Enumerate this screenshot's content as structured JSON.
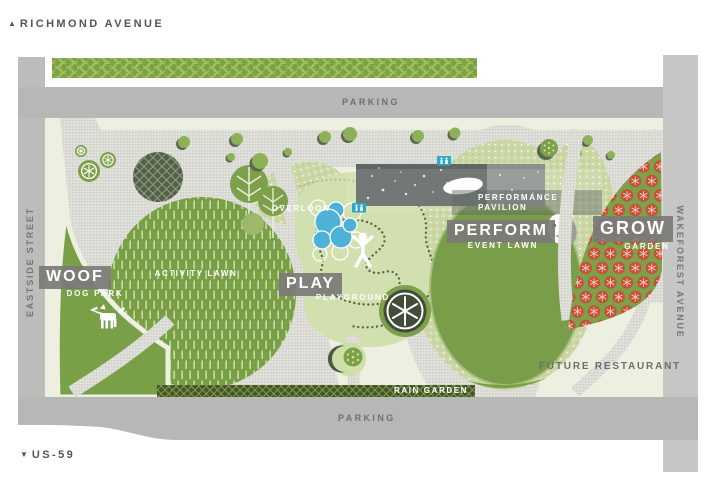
{
  "streets": {
    "richmond": {
      "arrow": "▲",
      "label": "RICHMOND AVENUE"
    },
    "us59": {
      "arrow": "▼",
      "label": "US-59"
    },
    "eastside": {
      "label": "EASTSIDE STREET"
    },
    "wakeforest": {
      "label": "WAKEFOREST AVENUE"
    },
    "parking_top": {
      "label": "PARKING"
    },
    "parking_bottom": {
      "label": "PARKING"
    }
  },
  "zones": {
    "woof": {
      "title": "WOOF",
      "subtitle": "DOG PARK"
    },
    "play": {
      "title": "PLAY",
      "subtitle": "PLAYGROUND"
    },
    "perform": {
      "title": "PERFORM",
      "subtitle": "EVENT LAWN"
    },
    "grow": {
      "title": "GROW",
      "subtitle": "GARDEN"
    },
    "activity_lawn": {
      "label": "ACTIVITY LAWN"
    },
    "overlook": {
      "label": "OVERLOOK"
    },
    "pavilion": {
      "line1": "PERFORMANCE",
      "line2": "PAVILION"
    },
    "future_restaurant": {
      "label": "FUTURE RESTAURANT"
    },
    "rain_garden": {
      "label": "RAIN GARDEN"
    }
  },
  "colors": {
    "park_green": "#7da14b",
    "playground_green": "#d2dfae",
    "cream": "#edefe0",
    "garden_red": "#c84f36",
    "pond_blue": "#4db1d8",
    "restroom_blue": "#2ea7cc",
    "parking_gray": "#b7b7b5",
    "street_gray_right": "#c6c6c4",
    "label_box_gray": "#7d7d7b",
    "rain_garden_dark": "#47542e",
    "pavilion_dark": "#5f6664"
  }
}
